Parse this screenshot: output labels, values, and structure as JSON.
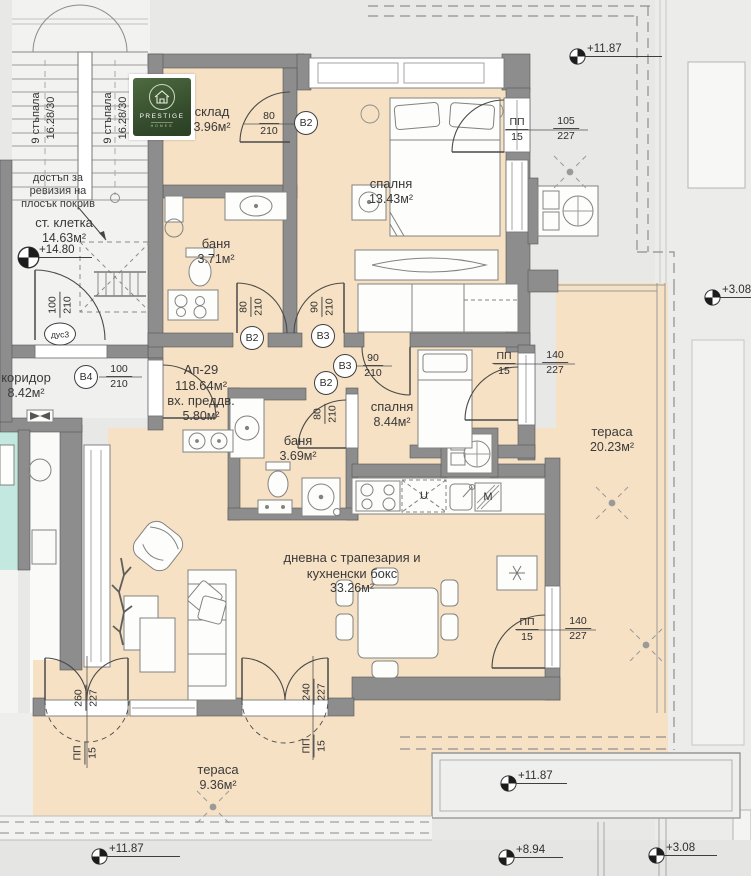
{
  "logo": {
    "brand": "PRESTIGE",
    "sub": "HOMES"
  },
  "apartment": {
    "id": "Ап-29",
    "total_area": "118.64м²"
  },
  "rooms": {
    "sklad": {
      "name": "склад",
      "area": "3.96м²"
    },
    "bedroom1": {
      "name": "спалня",
      "area": "13.43м²"
    },
    "bath1": {
      "name": "баня",
      "area": "3.71м²"
    },
    "stairwell": {
      "name": "ст. клетка",
      "area": "14.63м²"
    },
    "corridor": {
      "name": "коридор",
      "area": "8.42м²"
    },
    "entry": {
      "name": "вх. преддв.",
      "area": "5.80м²"
    },
    "bath2": {
      "name": "баня",
      "area": "3.69м²"
    },
    "bedroom2": {
      "name": "спалня",
      "area": "8.44м²"
    },
    "terrace_right": {
      "name": "тераса",
      "area": "20.23м²"
    },
    "living": {
      "name1": "дневна с трапезария и",
      "name2": "кухненски бокс",
      "area": "33.26м²"
    },
    "terrace_bottom": {
      "name": "тераса",
      "area": "9.36м²"
    }
  },
  "stairs": {
    "flight": "9 стъпала",
    "size": "16.28/30",
    "note1": "достъп за",
    "note2": "ревизия на",
    "note3": "плосък покрив"
  },
  "levels": {
    "stairwell": "+14.80",
    "roof_top": "+11.87",
    "right_edge": "+3.08",
    "terrace_mid": "+11.87",
    "bottom_left": "+11.87",
    "bottom_low": "+8.94",
    "bottom_right": "+3.08"
  },
  "doors": {
    "sklad": {
      "tag": "В2",
      "num": "80",
      "den": "210"
    },
    "bath1": {
      "tag": "В2",
      "num": "80",
      "den": "210"
    },
    "hall": {
      "tag": "В3",
      "num": "90",
      "den": "210"
    },
    "bedroom2": {
      "tag": "В3",
      "num": "90",
      "den": "210"
    },
    "bath2": {
      "tag": "В2",
      "num": "80",
      "den": "210"
    },
    "corridor": {
      "tag": "В4",
      "num": "100",
      "den": "210"
    },
    "stair": {
      "tag": "дус3",
      "num": "100",
      "den": "210"
    },
    "bedroom1_terrace": {
      "pp": "ПП",
      "pp2": "15",
      "num": "105",
      "den": "227"
    },
    "bedroom2_terrace": {
      "pp": "ПП",
      "pp2": "15",
      "num": "140",
      "den": "227"
    },
    "living_terrace": {
      "pp": "ПП",
      "pp2": "15",
      "num": "140",
      "den": "227"
    },
    "terrace_door_left": {
      "pp": "ПП",
      "pp2": "15",
      "num": "260",
      "den": "227"
    },
    "terrace_door_right": {
      "pp": "ПП",
      "pp2": "15",
      "num": "240",
      "den": "227"
    }
  },
  "kitchen": {
    "dishwasher": "U",
    "sink_unit": "М"
  }
}
